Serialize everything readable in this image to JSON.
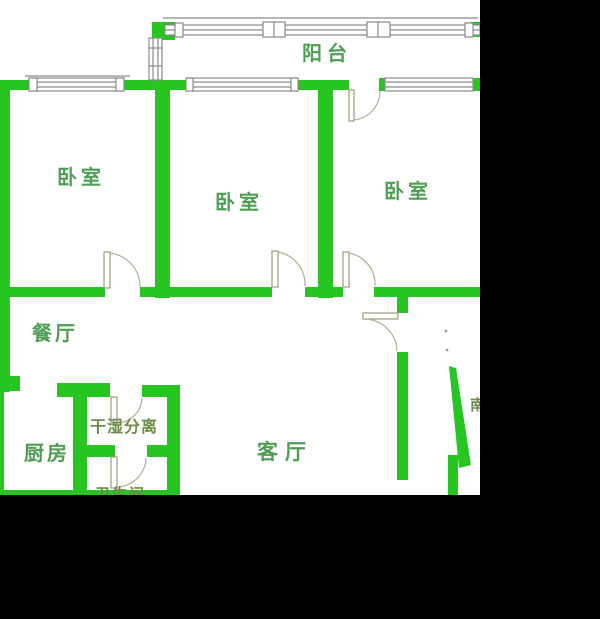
{
  "title": "apartment-floor-plan",
  "rooms": [
    {
      "id": "balcony",
      "label": "阳台"
    },
    {
      "id": "bedroom-left",
      "label": "卧室"
    },
    {
      "id": "bedroom-middle",
      "label": "卧室"
    },
    {
      "id": "bedroom-right",
      "label": "卧室"
    },
    {
      "id": "dining-room",
      "label": "餐厅"
    },
    {
      "id": "kitchen",
      "label": "厨房"
    },
    {
      "id": "living-room",
      "label": "客厅"
    },
    {
      "id": "dry-wet-separation",
      "label": "干湿分离"
    },
    {
      "id": "bathroom-clipped",
      "label": "卫生间"
    },
    {
      "id": "south-clipped",
      "label": "南"
    }
  ],
  "colors": {
    "wall": "#26c521",
    "line": "#8a8a8a",
    "door": "#9b9b7a",
    "arc": "#b0b096",
    "label": "#4f9e55",
    "label-olive": "#6d8c4a",
    "mask": "#000000",
    "bg": "#ffffff"
  }
}
